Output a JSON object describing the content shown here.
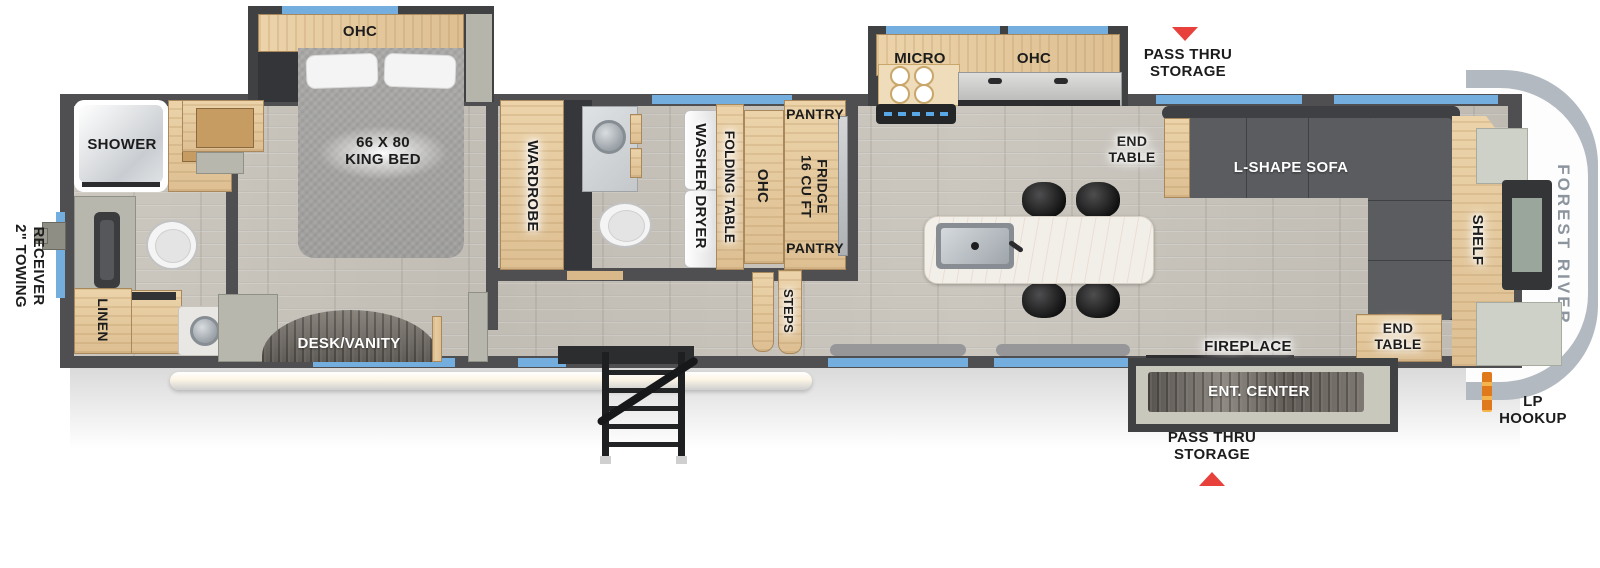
{
  "colors": {
    "wall": "#4f4f51",
    "slide_wall": "#3f4143",
    "floor": "#c8c4bc",
    "wood": "#e3c89e",
    "wood_dark": "#c79c62",
    "window_blue": "#74aede",
    "sofa": "#5a5c5f",
    "sofa_back": "#3e4043",
    "marble": "#f2eee8",
    "accent_red": "#e8413c",
    "lp_orange": "#e0791c",
    "cap_gray": "#b2b9c1",
    "brand_gray": "#8c949d",
    "bed_gray": "#a6a5a3",
    "panel_gray": "#b7b7ad",
    "label_black": "#1c1c1c"
  },
  "exterior": {
    "brand": "FOREST RIVER",
    "towing_line1": "2\" TOWING",
    "towing_line2": "RECEIVER",
    "pass_thru_top_line1": "PASS THRU",
    "pass_thru_top_line2": "STORAGE",
    "pass_thru_bottom_line1": "PASS THRU",
    "pass_thru_bottom_line2": "STORAGE",
    "lp_line1": "LP",
    "lp_line2": "HOOKUP"
  },
  "bedroom": {
    "ohc": "OHC",
    "bed_line1": "66 X 80",
    "bed_line2": "KING BED",
    "wardrobe": "WARDROBE"
  },
  "rear_bath": {
    "shower": "SHOWER",
    "linen": "LINEN"
  },
  "vanity_room": {
    "desk": "DESK/VANITY"
  },
  "mid_bath": {
    "washer_dryer": "WASHER DRYER",
    "folding_table": "FOLDING TABLE",
    "ohc": "OHC"
  },
  "kitchen": {
    "pantry_top": "PANTRY",
    "pantry_bottom": "PANTRY",
    "fridge_line1": "16 CU FT",
    "fridge_line2": "FRIDGE",
    "micro": "MICRO",
    "ohc": "OHC",
    "steps": "STEPS"
  },
  "living": {
    "end_table_top_line1": "END",
    "end_table_top_line2": "TABLE",
    "sofa": "L-SHAPE SOFA",
    "shelf": "SHELF",
    "end_table_bottom_line1": "END",
    "end_table_bottom_line2": "TABLE",
    "fireplace": "FIREPLACE",
    "ent_center": "ENT. CENTER"
  }
}
